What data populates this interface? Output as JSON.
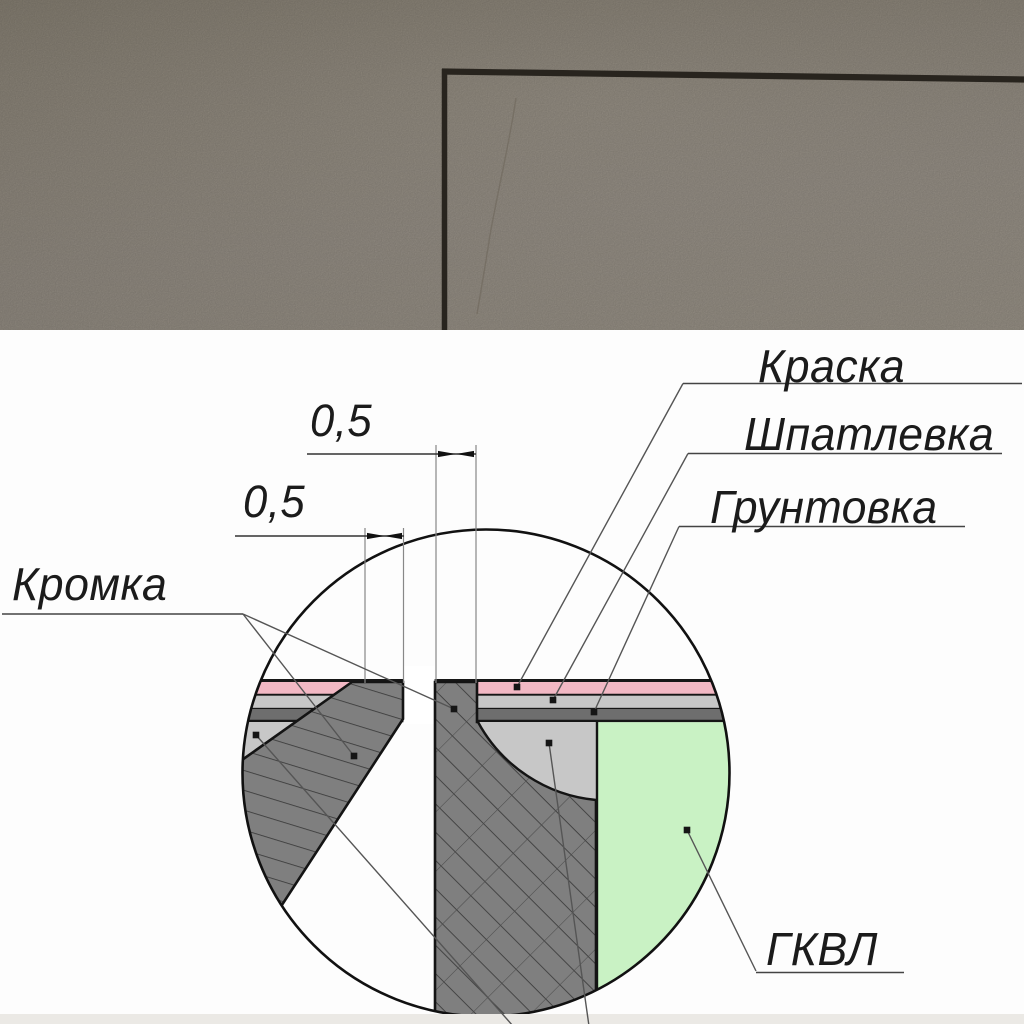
{
  "photo": {
    "colors": {
      "wall": "#968f85",
      "shadow_line": "#28241e"
    }
  },
  "diagram": {
    "callouts": [
      {
        "id": "paint",
        "label": "Краска"
      },
      {
        "id": "putty",
        "label": "Шпатлевка"
      },
      {
        "id": "primer",
        "label": "Грунтовка"
      },
      {
        "id": "edge",
        "label": "Кромка"
      },
      {
        "id": "board",
        "label": "ГКВЛ"
      }
    ],
    "dimensions": [
      "0,5",
      "0,5"
    ],
    "colors": {
      "paint_layer": "#f2b8c4",
      "putty_layer": "#c7c7c7",
      "primer_layer": "#6e6e6e",
      "board_face": "#c9f2c4",
      "gypsum_core": "#7f7f7f",
      "outline": "#141414"
    }
  }
}
